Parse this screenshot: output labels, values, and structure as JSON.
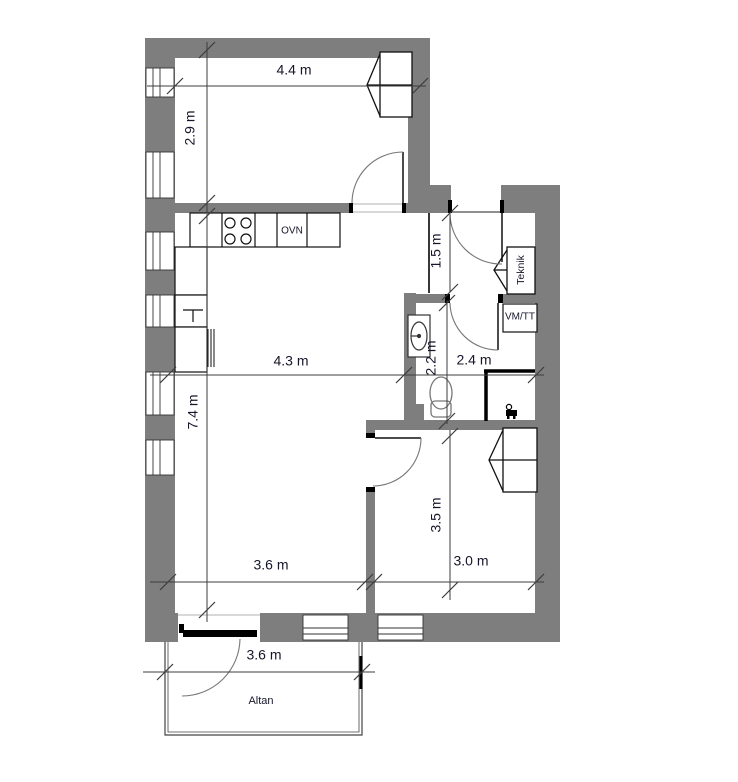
{
  "dimensions": {
    "bedroom1_width": "4.4 m",
    "bedroom1_depth": "2.9 m",
    "entry_depth": "1.5 m",
    "living_width": "4.3 m",
    "bathroom_width": "2.4 m",
    "bathroom_depth": "2.2 m",
    "living_depth": "7.4 m",
    "living_bottom_width": "3.6 m",
    "bedroom2_width": "3.0 m",
    "bedroom2_depth": "3.5 m",
    "balcony_width": "3.6 m"
  },
  "rooms": {
    "balcony": "Altan"
  },
  "fixtures": {
    "oven": "OVN",
    "tech_closet": "Teknik",
    "washer_dryer": "VM/TT"
  },
  "colors": {
    "wall": "#7e7e7e",
    "outline": "#1a1a1a",
    "dimension": "#3c3c3c",
    "label": "#16162a"
  }
}
